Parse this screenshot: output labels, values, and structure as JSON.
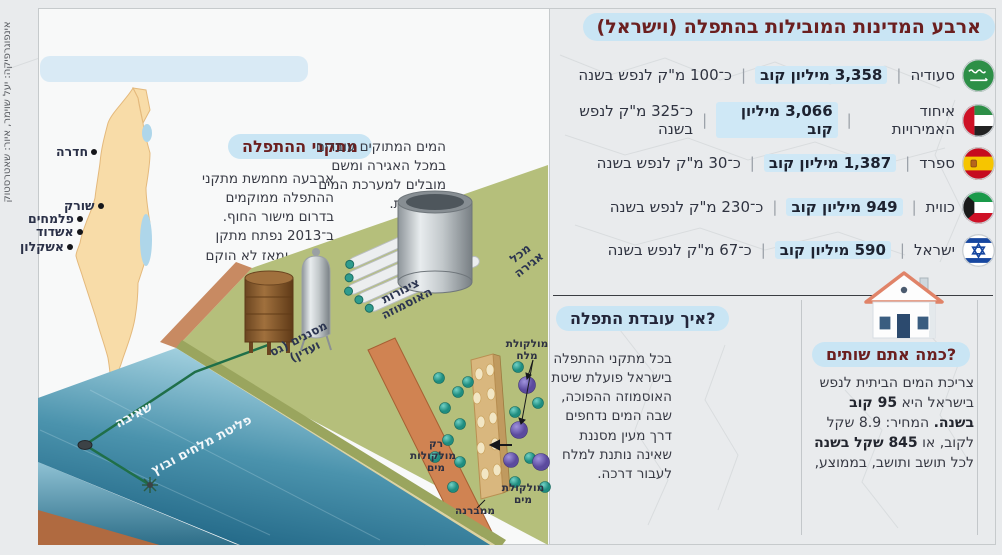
{
  "credit": "אינפוגרפיקה: יעל שוימר, איור: שאטרסטוק",
  "title": "ארבע המדינות המובילות בהתפלה (וישראל)",
  "countries": [
    {
      "name": "סעודיה",
      "volume": "3,358 מיליון קוב",
      "per_capita": "כ־100 מ\"ק לנפש בשנה"
    },
    {
      "name": "איחוד האמירויות",
      "volume": "3,066 מיליון קוב",
      "per_capita": "כ־325 מ\"ק לנפש בשנה"
    },
    {
      "name": "ספרד",
      "volume": "1,387 מיליון קוב",
      "per_capita": "כ־30 מ\"ק לנפש בשנה"
    },
    {
      "name": "כווית",
      "volume": "949 מיליון קוב",
      "per_capita": "כ־230 מ\"ק לנפש בשנה"
    },
    {
      "name": "ישראל",
      "volume": "590 מיליון קוב",
      "per_capita": "כ־67 מ\"ק לנפש בשנה"
    }
  ],
  "map": {
    "cities": [
      "חדרה",
      "שורק",
      "פלמחים",
      "אשדוד",
      "אשקלון"
    ]
  },
  "facilities_section": {
    "heading": "מתקני ההתפלה",
    "body": "ארבעה מחמשת מתקני ההתפלה ממוקמים בדרום מישור החוף. ב־2013 נפתח מתקן אשדוד, ומאז לא הוקם מתקן חדש."
  },
  "storage_note": "המים המתוקים עוברים במכל האגירה ומשם מובלים למערכת המים המקומית.",
  "plant_labels": {
    "filters": "מסננים (גס ועדין)",
    "osmosis_pipes": "צינורות האוסמוזה",
    "storage_tank": "מכל אגירה",
    "pumping": "שאיבה",
    "discharge": "פליטת מלחים ובוץ"
  },
  "how_section": {
    "heading": "איך עובדת התפלה?",
    "body": "בכל מתקני ההתפלה בישראל פועלת שיטת האוסמוזה ההפוכה, שבה המים נדחפים דרך מעין מסננת שאינה נותנת למלח לעבור דרכה."
  },
  "molecule_labels": {
    "salt": "מולקולת מלח",
    "only_water": "רק מולקולות מים",
    "water": "מולקולת מים",
    "membrane": "ממברנה"
  },
  "drink_section": {
    "heading": "כמה אתם שותים?",
    "segments": {
      "s0": "צריכת המים הביתית לנפש בישראל היא ",
      "s1": "95 קוב בשנה.",
      "s2": " המחיר: 8.9 שקל לקוב, או ",
      "s3": "845 שקל בשנה",
      "s4": " לכל תושב ותושב, בממוצע,"
    }
  },
  "colors": {
    "heading_red": "#6b1f1f",
    "pill_blue": "#c9e5f4",
    "land_tan": "#f8dca8",
    "platform_green": "#b5bf7b",
    "sea_deep": "#14597a",
    "salt_molecule": "#6f5fb5",
    "water_molecule": "#2fa99b"
  }
}
